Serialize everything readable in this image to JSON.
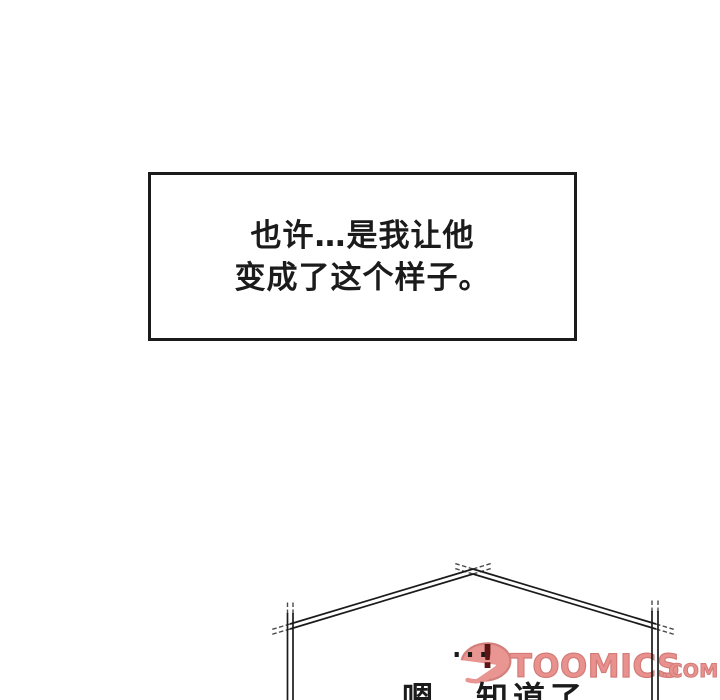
{
  "colors": {
    "background": "#ffffff",
    "ink": "#1b1b1b",
    "brand_pink": "#e9918e",
    "brand_outline": "#d27b77",
    "blend_dark_red": "#5c1414"
  },
  "narration_box": {
    "line1": "也许…是我让他",
    "line2": "变成了这个样子。"
  },
  "dialogue": {
    "ellipsis": "…",
    "exclamation": "!",
    "line": "嗯，知道了"
  },
  "watermark": {
    "brand": "TOOMICS",
    "tld": ".COM"
  }
}
